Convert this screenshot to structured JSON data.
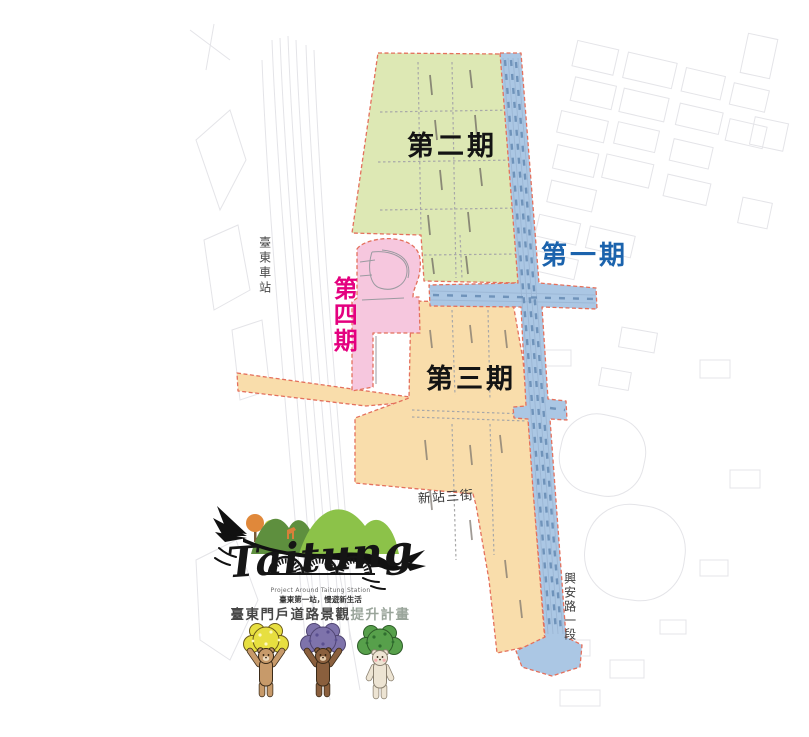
{
  "map": {
    "phase_labels": {
      "phase1": {
        "text": "第一期",
        "color": "#1b63ad"
      },
      "phase2": {
        "text": "第二期",
        "color": "#141414"
      },
      "phase3": {
        "text": "第三期",
        "color": "#141414"
      },
      "phase4": {
        "text": "第四期",
        "color": "#e4007f"
      }
    },
    "zone_colors": {
      "phase1_road": "#abc7e4",
      "phase2_zone": "#dde8b4",
      "phase3_zone": "#f9ddab",
      "phase4_zone": "#f6c7de",
      "boundary_dash": "#e4705c"
    },
    "place_labels": {
      "taitung_station": "臺東車站",
      "xinzhan_3rd_street": "新站三街",
      "xingan_road_sec1": "興安路一段"
    }
  },
  "logo": {
    "wordmark": "Taitung",
    "tagline_en": "Project Around Taitung Station",
    "tagline_zh": "臺東第一站，慢遊新生活",
    "title_main": "臺東門戶道路景觀",
    "title_sub": "提升計畫"
  }
}
